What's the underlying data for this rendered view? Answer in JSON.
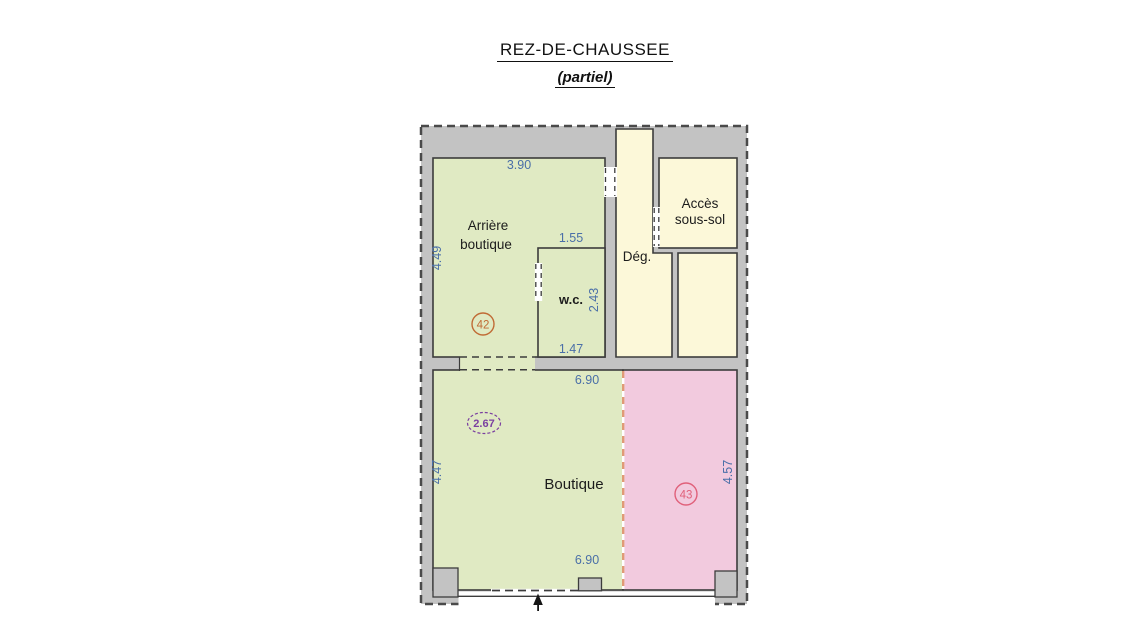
{
  "title": {
    "main": "REZ-DE-CHAUSSEE",
    "sub": "(partiel)"
  },
  "rooms": {
    "arriere_boutique": {
      "line1": "Arrière",
      "line2": "boutique"
    },
    "wc": {
      "label": "w.c."
    },
    "degagement": {
      "label": "Dég."
    },
    "acces_sous_sol": {
      "line1": "Accès",
      "line2": "sous-sol"
    },
    "boutique": {
      "label": "Boutique"
    }
  },
  "dimensions": {
    "arriere_width_top": "3.90",
    "arriere_height_left": "4.49",
    "wc_width_top": "1.55",
    "wc_height_right": "2.43",
    "wc_width_bottom": "1.47",
    "boutique_width_top": "6.90",
    "boutique_width_bottom": "6.90",
    "boutique_height_left": "4.47",
    "lot43_height_right": "4.57"
  },
  "markers": {
    "lot_42": "42",
    "lot_43": "43",
    "ceiling_height": "2.67"
  },
  "colors": {
    "wall_gray": "#c3c3c3",
    "room_green": "#e0eac3",
    "room_cream": "#fcf8d9",
    "room_pink": "#f2cade",
    "dimension_blue": "#4a6fa8",
    "marker_42": "#c06b35",
    "marker_43": "#e0607a",
    "marker_height": "#7a3fa0",
    "divider_salmon": "#e09a76",
    "line_dark": "#3c3c3c"
  }
}
